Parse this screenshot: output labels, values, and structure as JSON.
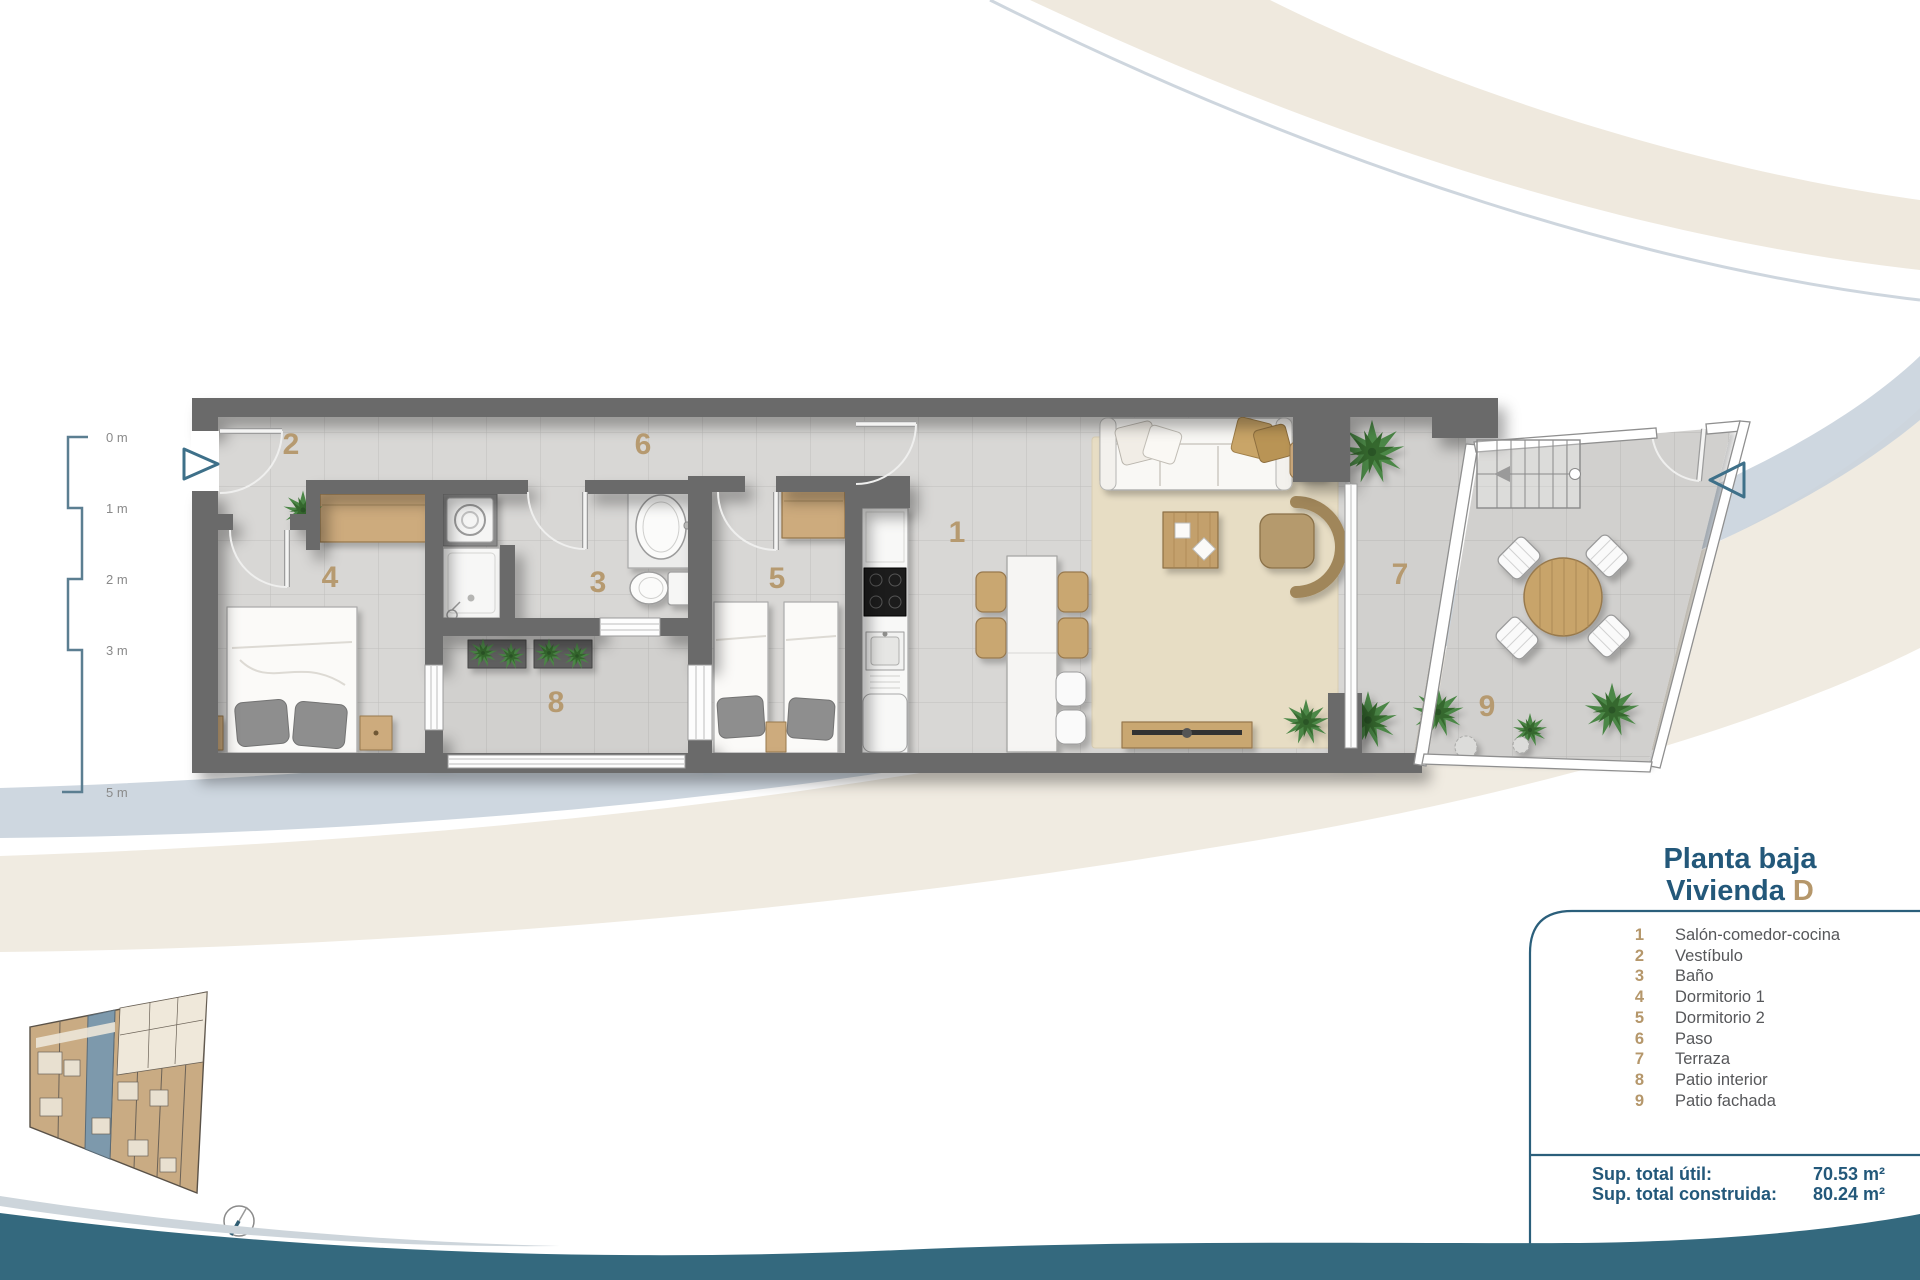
{
  "rooms": [
    {
      "num": "1",
      "label": "Salón-comedor-cocina"
    },
    {
      "num": "2",
      "label": "Vestíbulo"
    },
    {
      "num": "3",
      "label": "Baño"
    },
    {
      "num": "4",
      "label": "Dormitorio 1"
    },
    {
      "num": "5",
      "label": "Dormitorio 2"
    },
    {
      "num": "6",
      "label": "Paso"
    },
    {
      "num": "7",
      "label": "Terraza"
    },
    {
      "num": "8",
      "label": "Patio interior"
    },
    {
      "num": "9",
      "label": "Patio fachada"
    }
  ],
  "title": {
    "line1": "Planta baja",
    "line2_prefix": "Vivienda",
    "line2_unit": "D"
  },
  "totals": [
    {
      "label": "Sup. total útil:",
      "value": "70.53 m²"
    },
    {
      "label": "Sup. total construida:",
      "value": "80.24 m²"
    }
  ],
  "scale_labels": [
    "0 m",
    "1 m",
    "2 m",
    "3 m",
    "5 m"
  ],
  "colors": {
    "accent_teal": "#23587a",
    "accent_tan": "#b5976b",
    "wall_gray": "#6b6b6b",
    "footer_wave": "#34697e",
    "swoosh_blue": "#c9d3dd",
    "swoosh_beige": "#f0ebe1"
  }
}
